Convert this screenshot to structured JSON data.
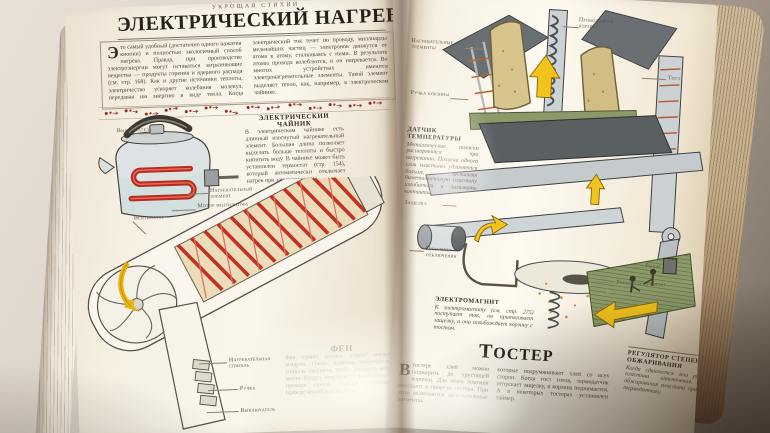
{
  "running_head": "УКРОЩАЯ СТИХИИ",
  "title": "ЭЛЕКТРИЧЕСКИЙ НАГРЕВ",
  "colors": {
    "paper": "#f7f1e6",
    "coil_red": "#b92b1f",
    "arrow_yellow": "#f2c31d",
    "toaster_green": "#8b9a68",
    "body_text": "#584c41"
  },
  "intro": {
    "dropcap": "Э",
    "col1": "то самый удобный (достаточно одного нажатия кнопки) и полностью экологичный способ нагрева. Правда, при производстве электроэнергии могут оставаться загрязняющие вещества — продукты горения и ядерного распада (см. стр. 168). Как и другие источники теплоты, электричество ускоряет колебания молекул, передавая им энергию в виде тепла.",
    "col2": "Когда электрический ток течет по проводу, миллиарды мельчайших частиц — электронов движутся от атома к атому, сталкиваясь с ними. В результате атомы провода колеблются, и он нагревается. Во многих устройствах имеются электронагревательные элементы. Такой элемент выделяет тепло, как, например, в электрическом чайнике."
  },
  "kettle": {
    "heading": "ЭЛЕКТРИЧЕСКИЙ ЧАЙНИК",
    "body": "В электрическом чайнике есть длинный изогнутый нагревательный элемент. Большая длина позволяет выделять больше теплоты и быстро кипятить воду. В чайнике может быть установлен термостат (стр. 154), который автоматически отключает нагрев при закипании воды.",
    "label_switch": "Выключатель",
    "label_element": "Нагревательный элемент"
  },
  "dryer": {
    "heading": "ФЕН",
    "body": "Фен сушит волосы струей нагретого воздуха. Очень длинная нагревательная спираль свернута, чтобы занимать меньше места. Воздух затягивается вентилятором и, проходя сквозь спираль, нагревается, прежде чем обдуть волосы.",
    "label_motor": "Мотор вентилятора",
    "label_fan": "Вентилятор",
    "label_coil": "Нагревательная спираль",
    "label_handle": "Ручка",
    "label_switch": "Выключатель"
  },
  "toaster": {
    "heading": "ТОСТЕР",
    "dropcap": "В",
    "col1": "тостере хлеб можно поджарить до хрустящей корочки. Для этого ломтики опускают в прорези тостера. При этом включаются нагревательные элементы,",
    "col2": "которые подрумянивают хлеб со всех сторон. Когда тост готов, термодатчик отпускает защелку, и корзина поднимается. А в некоторых тостерах установлен таймер.",
    "label_basket": "Проволочная корзина",
    "label_toast": "Тост",
    "label_elements": "Нагревательные элементы",
    "label_basket_handle": "Ручка корзины",
    "label_latch": "Защелка",
    "label_plate": "Пластина отключения",
    "label_lever": "Рычаг",
    "label_timer": "Регулятор времени"
  },
  "sensor_note": {
    "heading": "ДАТЧИК ТЕМПЕРАТУРЫ",
    "body": "Металлические полоски расширяются при нагревании. Полоска одного слоя пластины удлиняется больше, заставляя биметаллическую пластину изгибаться и замыкать контакты."
  },
  "magnet_note": {
    "heading": "ЭЛЕКТРОМАГНИТ",
    "body": "К электромагниту (см. стр. 275) поступает ток, он притягивает защелку, и она освобождает корзину с тостом."
  },
  "browning_note": {
    "heading": "РЕГУЛЯТОР СТЕПЕНИ ОБЖАРИВАНИЯ",
    "body": "Когда сдвигается эта ручка, сдвигается и пластина отключения. Для меньшего обжаривания пластина придвигается ближе к термодатчику."
  }
}
